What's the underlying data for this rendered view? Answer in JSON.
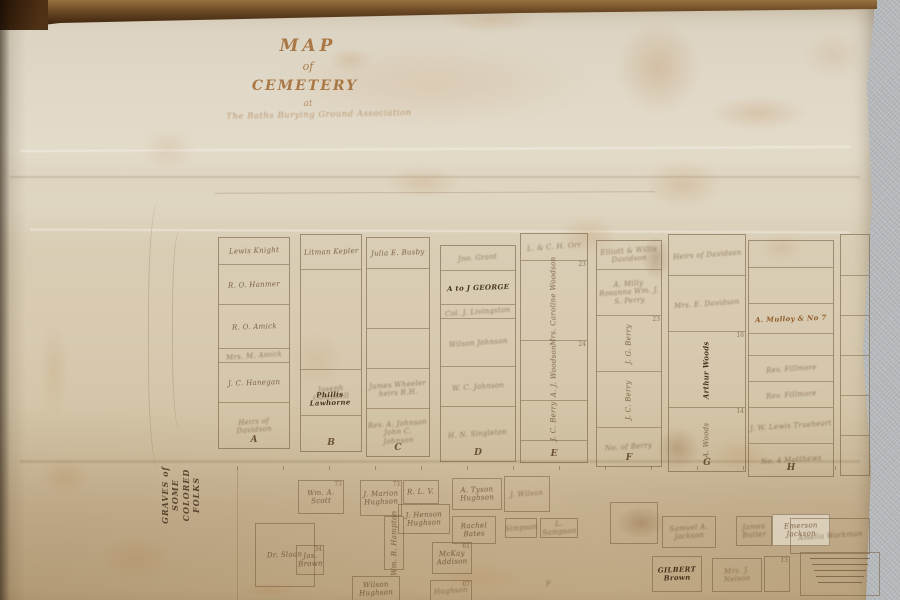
{
  "colors": {
    "paper": "#d9cdb4",
    "paper_bottom": "#c2ab86",
    "ink_dark": "#3a2612",
    "ink_faded": "#8a6a45",
    "title_ink": "#a0672f",
    "wood_rail": "#5a3a1e",
    "wall": "#b6b9bc"
  },
  "map": {
    "title": {
      "line1": "MAP",
      "line2": "of",
      "line3": "CEMETERY",
      "line4": "at",
      "subtitle": "The Baths Burying Ground Association"
    },
    "side_label": {
      "line1": "GRAVES of SOME",
      "line2": "COLORED FOLKS"
    },
    "note": {
      "legibility": "illegible fine print",
      "line_count": 5
    },
    "sections": [
      {
        "letter": "A",
        "x": 218,
        "y": 237,
        "w": 70,
        "h": 210,
        "rows": [
          {
            "y": 0,
            "h": 26,
            "label": "Lewis Knight"
          },
          {
            "y": 26,
            "h": 40,
            "label": "R. O. Hanmer"
          },
          {
            "y": 66,
            "h": 44,
            "label": "R. O. Amick"
          },
          {
            "y": 110,
            "h": 14,
            "label": "Mrs. M. Amick",
            "script": true
          },
          {
            "y": 124,
            "h": 40,
            "label": "J. C. Hanegan"
          },
          {
            "y": 164,
            "h": 46,
            "label": "Heirs of Davidson",
            "script": true
          }
        ]
      },
      {
        "letter": "B",
        "x": 300,
        "y": 234,
        "w": 60,
        "h": 216,
        "rows": [
          {
            "y": 0,
            "h": 34,
            "label": "Litman Kepler"
          },
          {
            "y": 34,
            "h": 100,
            "label": ""
          },
          {
            "y": 134,
            "h": 46,
            "label": "Joseph Campbell",
            "script": true
          },
          {
            "y": 180,
            "h": 36,
            "label": ""
          }
        ]
      },
      {
        "letter": "C",
        "x": 366,
        "y": 237,
        "w": 62,
        "h": 218,
        "rows": [
          {
            "y": 0,
            "h": 30,
            "label": "Julia E. Busby"
          },
          {
            "y": 30,
            "h": 60,
            "label": "",
            "script": true
          },
          {
            "y": 90,
            "h": 40,
            "label": ""
          },
          {
            "y": 130,
            "h": 40,
            "label": "James Wheeler heirs R.H.",
            "script": true
          },
          {
            "y": 170,
            "h": 48,
            "label": "Rev. A. Johnson John C. Johnson",
            "script": true
          }
        ]
      },
      {
        "letter": "D",
        "x": 440,
        "y": 245,
        "w": 74,
        "h": 215,
        "rows": [
          {
            "y": 0,
            "h": 24,
            "label": "Jno. Grant",
            "script": true
          },
          {
            "y": 24,
            "h": 34,
            "label": "A to J GEORGE",
            "ink": "dark"
          },
          {
            "y": 58,
            "h": 14,
            "label": "Col. J. Livingston",
            "script": true
          },
          {
            "y": 72,
            "h": 48,
            "label": "Wilson Johnson",
            "script": true
          },
          {
            "y": 120,
            "h": 40,
            "label": "W. C. Johnson",
            "script": true
          },
          {
            "y": 160,
            "h": 55,
            "label": "H. N. Singleton",
            "script": true
          }
        ]
      },
      {
        "letter": "E",
        "x": 520,
        "y": 233,
        "w": 66,
        "h": 228,
        "rows": [
          {
            "y": 0,
            "h": 26,
            "label": "L. & C. H. Orr",
            "script": true
          },
          {
            "y": 26,
            "h": 80,
            "label": "Mrs. Caroline Woodson",
            "vert": true,
            "num": "23"
          },
          {
            "y": 106,
            "h": 60,
            "label": "A. J. Woodson",
            "vert": true,
            "num": "24"
          },
          {
            "y": 166,
            "h": 40,
            "label": "J. C. Berry",
            "vert": true
          },
          {
            "y": 206,
            "h": 22,
            "label": ""
          }
        ]
      },
      {
        "letter": "F",
        "x": 596,
        "y": 240,
        "w": 64,
        "h": 225,
        "rows": [
          {
            "y": 0,
            "h": 28,
            "label": "Elliott & Willis Davidson",
            "script": true
          },
          {
            "y": 28,
            "h": 46,
            "label": "A. Milly Rosanna Wm. J. S. Perry",
            "script": true
          },
          {
            "y": 74,
            "h": 56,
            "label": "J. G. Berry",
            "vert": true,
            "num": "23"
          },
          {
            "y": 130,
            "h": 56,
            "label": "J. C. Berry",
            "vert": true
          },
          {
            "y": 186,
            "h": 39,
            "label": "No. of Berry",
            "script": true
          }
        ]
      },
      {
        "letter": "G",
        "x": 668,
        "y": 234,
        "w": 76,
        "h": 236,
        "rows": [
          {
            "y": 0,
            "h": 40,
            "label": "Heirs of Davidson",
            "script": true
          },
          {
            "y": 40,
            "h": 56,
            "label": "Mrs. E. Davidson",
            "script": true
          },
          {
            "y": 96,
            "h": 76,
            "label": "Arthur Woods",
            "vert": true,
            "ink": "dark",
            "num": "16"
          },
          {
            "y": 172,
            "h": 64,
            "label": "A. Woods",
            "vert": true,
            "num": "14"
          }
        ]
      },
      {
        "letter": "H",
        "x": 748,
        "y": 240,
        "w": 84,
        "h": 235,
        "rows": [
          {
            "y": 0,
            "h": 26,
            "label": ""
          },
          {
            "y": 26,
            "h": 36,
            "label": ""
          },
          {
            "y": 62,
            "h": 30,
            "label": "A. Mulloy & No 7",
            "ink": "rust"
          },
          {
            "y": 92,
            "h": 22,
            "label": ""
          },
          {
            "y": 114,
            "h": 26,
            "label": "Rev. Fillmore",
            "script": true
          },
          {
            "y": 140,
            "h": 26,
            "label": "Rev. Fillmore",
            "script": true
          },
          {
            "y": 166,
            "h": 36,
            "label": "J. W. Lewis Trueheart",
            "script": true
          },
          {
            "y": 202,
            "h": 33,
            "label": "No. 4 Matthews",
            "script": true
          }
        ]
      },
      {
        "letter": "",
        "x": 840,
        "y": 234,
        "w": 28,
        "h": 240,
        "rows": [
          {
            "y": 0,
            "h": 40,
            "label": ""
          },
          {
            "y": 40,
            "h": 40,
            "label": ""
          },
          {
            "y": 80,
            "h": 40,
            "label": ""
          },
          {
            "y": 120,
            "h": 40,
            "label": ""
          },
          {
            "y": 160,
            "h": 40,
            "label": ""
          },
          {
            "y": 200,
            "h": 40,
            "label": ""
          }
        ]
      }
    ],
    "lower_plots": [
      {
        "x": 294,
        "y": 393,
        "w": 72,
        "h": 12,
        "label": "Phillis Lawhorne",
        "ink": "dark",
        "noborder": true
      },
      {
        "x": 298,
        "y": 480,
        "w": 44,
        "h": 32,
        "label": "Wm. A. Scott",
        "num": "73"
      },
      {
        "x": 255,
        "y": 523,
        "w": 58,
        "h": 62,
        "label": "Dr. Sloan"
      },
      {
        "x": 296,
        "y": 545,
        "w": 26,
        "h": 28,
        "label": "Jas. Brown",
        "num": "34"
      },
      {
        "x": 360,
        "y": 480,
        "w": 40,
        "h": 34,
        "label": "J. Marion Hughson",
        "num": "73"
      },
      {
        "x": 403,
        "y": 480,
        "w": 34,
        "h": 22,
        "label": "R. L. V."
      },
      {
        "x": 398,
        "y": 504,
        "w": 50,
        "h": 28,
        "label": "J. Henson Hughson"
      },
      {
        "x": 452,
        "y": 478,
        "w": 48,
        "h": 30,
        "label": "A. Tyson Hughson"
      },
      {
        "x": 504,
        "y": 476,
        "w": 44,
        "h": 34,
        "label": "J. Wilson",
        "script": true
      },
      {
        "x": 452,
        "y": 516,
        "w": 42,
        "h": 26,
        "label": "Rachel Bates"
      },
      {
        "x": 384,
        "y": 516,
        "w": 18,
        "h": 52,
        "label": "Wm. B. Hampton",
        "vert": true
      },
      {
        "x": 432,
        "y": 542,
        "w": 38,
        "h": 30,
        "label": "McKay Addison",
        "num": "61"
      },
      {
        "x": 352,
        "y": 576,
        "w": 46,
        "h": 24,
        "label": "Wilson Hughson"
      },
      {
        "x": 430,
        "y": 580,
        "w": 40,
        "h": 20,
        "label": "Hughson",
        "num": "67",
        "script": true
      },
      {
        "x": 505,
        "y": 518,
        "w": 30,
        "h": 18,
        "label": "Simpson",
        "script": true
      },
      {
        "x": 540,
        "y": 518,
        "w": 36,
        "h": 18,
        "label": "L. Sampson",
        "script": true
      },
      {
        "x": 540,
        "y": 576,
        "w": 18,
        "h": 16,
        "label": "F",
        "script": true,
        "noborder": true
      },
      {
        "x": 610,
        "y": 502,
        "w": 46,
        "h": 40,
        "label": ""
      },
      {
        "x": 662,
        "y": 516,
        "w": 52,
        "h": 30,
        "label": "Samuel A. Jackson",
        "script": true
      },
      {
        "x": 736,
        "y": 516,
        "w": 34,
        "h": 28,
        "label": "James Butler",
        "script": true
      },
      {
        "x": 772,
        "y": 514,
        "w": 56,
        "h": 30,
        "label": "Emerson Jackson",
        "light": true
      },
      {
        "x": 652,
        "y": 556,
        "w": 48,
        "h": 34,
        "label": "GILBERT Brown",
        "ink": "dark"
      },
      {
        "x": 712,
        "y": 558,
        "w": 48,
        "h": 32,
        "label": "Mrs. J. Nelson",
        "script": true
      },
      {
        "x": 764,
        "y": 556,
        "w": 24,
        "h": 34,
        "label": "",
        "num": "13"
      },
      {
        "x": 790,
        "y": 518,
        "w": 78,
        "h": 34,
        "label": "Amelia Workman",
        "script": true
      },
      {
        "x": 800,
        "y": 552,
        "w": 78,
        "h": 42,
        "label": "",
        "scribbles": 5
      }
    ]
  }
}
